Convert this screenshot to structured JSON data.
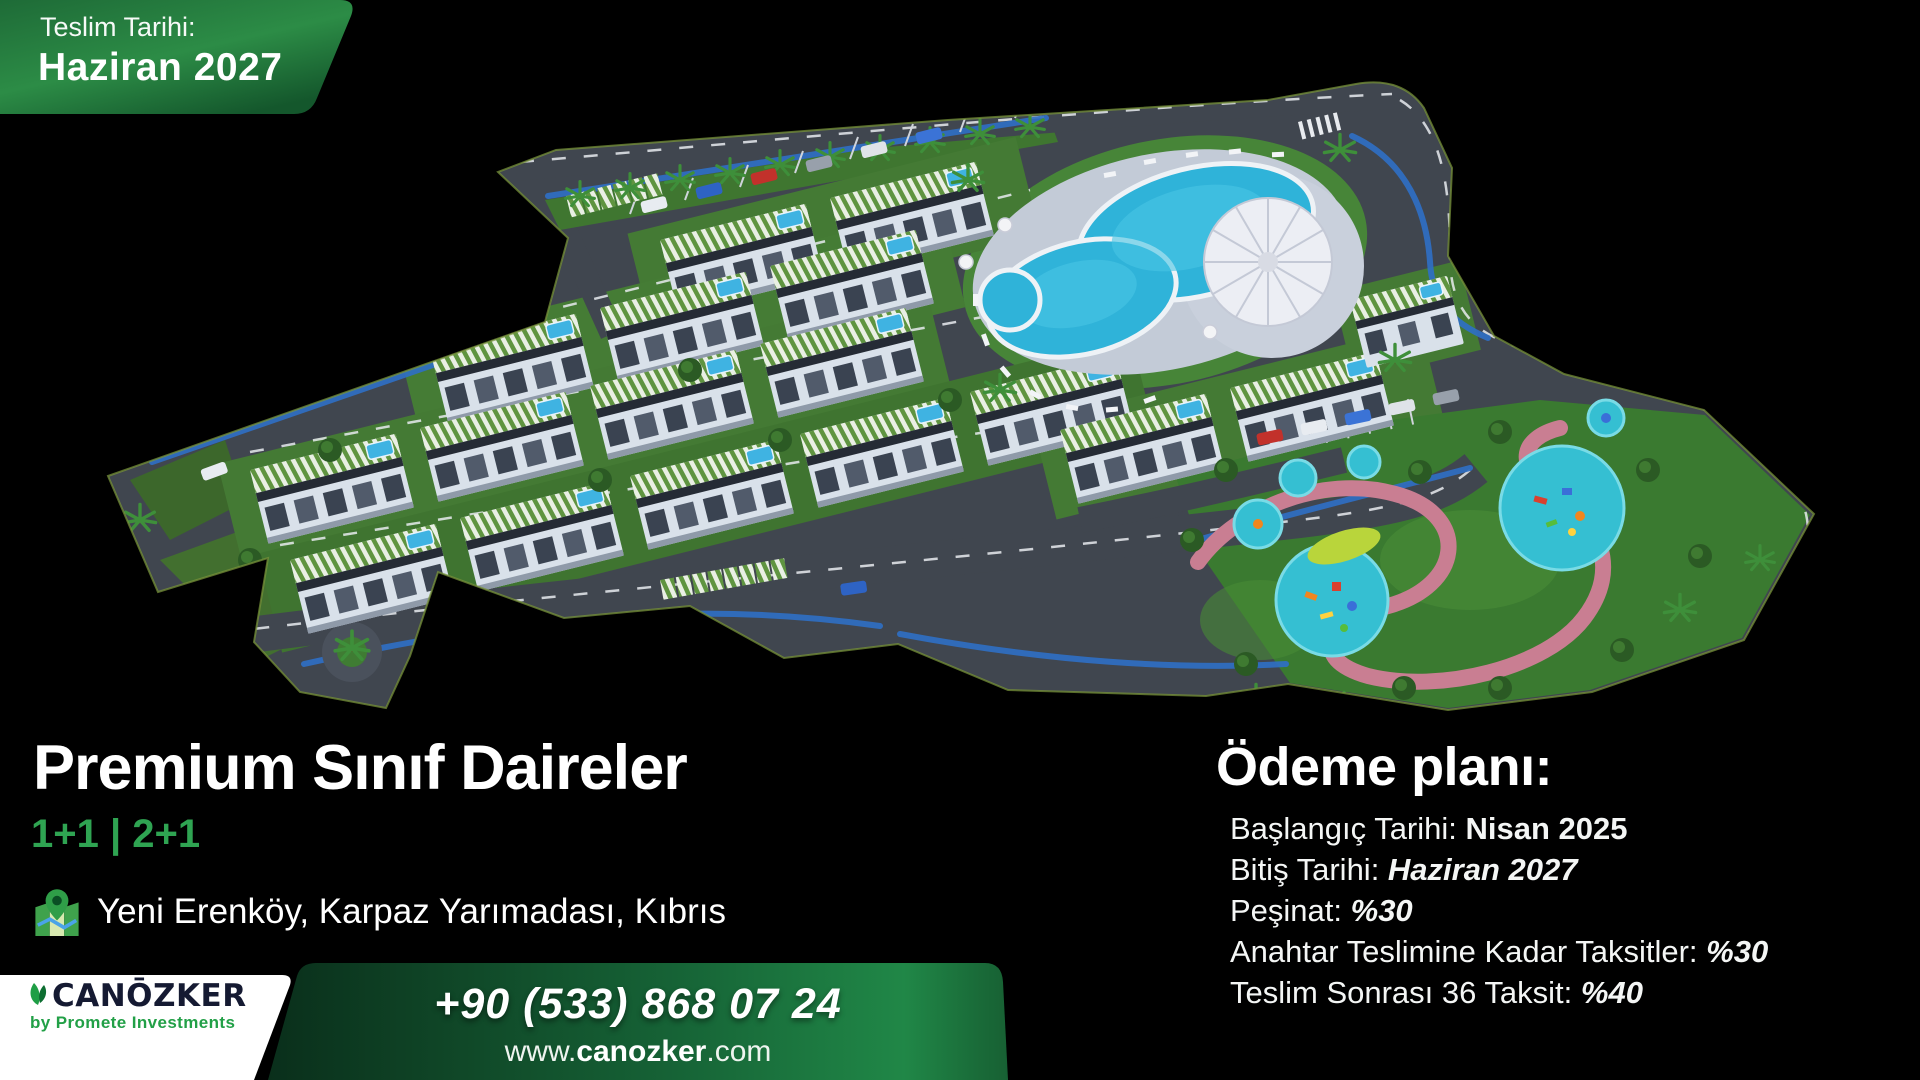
{
  "badge": {
    "label": "Teslim Tarihi:",
    "value": "Haziran 2027"
  },
  "title_block": {
    "title": "Premium Sınıf Daireler",
    "unit_types": "1+1 | 2+1",
    "location": "Yeni Erenköy, Karpaz Yarımadası, Kıbrıs"
  },
  "payment_plan": {
    "heading": "Ödeme planı:",
    "items": [
      {
        "label": "Başlangıç Tarihi: ",
        "value": "Nisan 2025",
        "value_style": "bold"
      },
      {
        "label": "Bitiş Tarihi: ",
        "value": "Haziran 2027",
        "value_style": "bold-italic"
      },
      {
        "label": "Peşinat: ",
        "value": "%30",
        "value_style": "bold-italic"
      },
      {
        "label": "Anahtar Teslimine Kadar Taksitler: ",
        "value": "%30",
        "value_style": "bold-italic"
      },
      {
        "label": "Teslim Sonrası 36 Taksit: ",
        "value": "%40",
        "value_style": "bold-italic"
      }
    ]
  },
  "footer": {
    "brand": {
      "name": "CANŌZKER",
      "tagline": "by Promete Investments"
    },
    "phone": "+90 (533) 868 07 24",
    "website": {
      "prefix": "www.",
      "domain": "canozker",
      "suffix": ".com"
    }
  },
  "illustration": {
    "name": "site-aerial-render",
    "alt": "3D aerial render of residential complex with pools, apartment blocks, roads and playground park"
  },
  "colors": {
    "accent_green": "#2fa452",
    "badge_green_dark": "#14572c",
    "badge_green_light": "#2c8c46",
    "band_green_dark": "#0a2f1b",
    "band_green_light": "#1f8443",
    "logo_navy": "#151a32",
    "logo_green": "#22a047",
    "pool_blue": "#2fb3d9",
    "park_path_pink": "#c97e92"
  }
}
